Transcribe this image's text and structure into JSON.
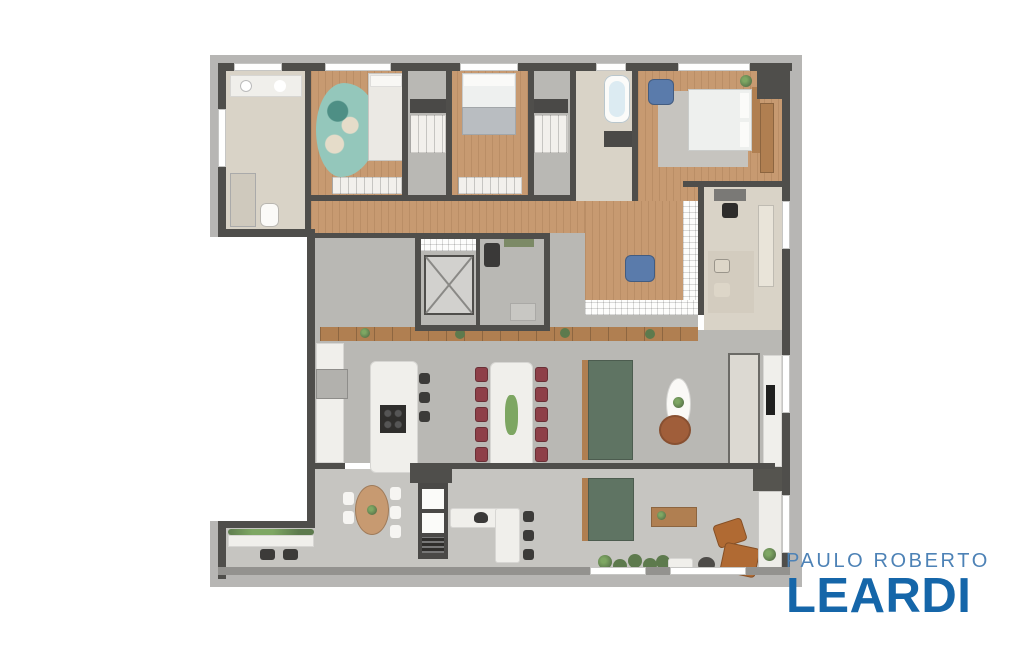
{
  "logo": {
    "top_line": "PAULO ROBERTO",
    "bottom_line": "LEARDI"
  },
  "palette": {
    "brand-light": "#4d82b6",
    "brand-dark": "#1566a9",
    "wall": "#4f4e4b",
    "outer-band": "#b7b6b4",
    "wood": "#c79a71",
    "wood-dark": "#b07f51",
    "floor-gray": "#b9b8b4",
    "terrace-gray": "#c6c5c1",
    "beige": "#d9d3c7",
    "white-surface": "#f0efeb",
    "rug-teal": "#94c7bb",
    "rug-gray": "#c6c4bf",
    "sofa-green": "#5f7463",
    "chair-maroon": "#8e3f48",
    "chair-blue": "#5a7bab",
    "armchair-rust": "#b06a33",
    "plant-green": "#5d7a4d",
    "dark-fixture": "#4a4947"
  },
  "floor_plan": {
    "type": "furnished-apartment-floor-plan",
    "rooms": [
      "bathroom",
      "bedroom-1",
      "closet-1",
      "bedroom-2",
      "closet-2",
      "master-bathroom",
      "master-bedroom",
      "hallway",
      "den",
      "home-office",
      "elevator-core",
      "kitchen",
      "dining-area",
      "living-room",
      "terrace-gourmet"
    ],
    "furniture": [
      "vanity",
      "toilet",
      "shower",
      "single-bed",
      "teal-rug",
      "wardrobe",
      "double-bed",
      "bathtub",
      "king-bed",
      "blue-armchair",
      "desk-with-chair",
      "elevator",
      "kitchen-island-with-stools",
      "dining-table-10-chairs",
      "green-sofa",
      "oval-coffee-table",
      "wood-frame-sofa",
      "tv-console",
      "breakfast-table",
      "oven-tower",
      "grill-counter-with-stools",
      "outdoor-green-sofa",
      "outdoor-coffee-table",
      "rust-armchairs",
      "planters"
    ]
  }
}
